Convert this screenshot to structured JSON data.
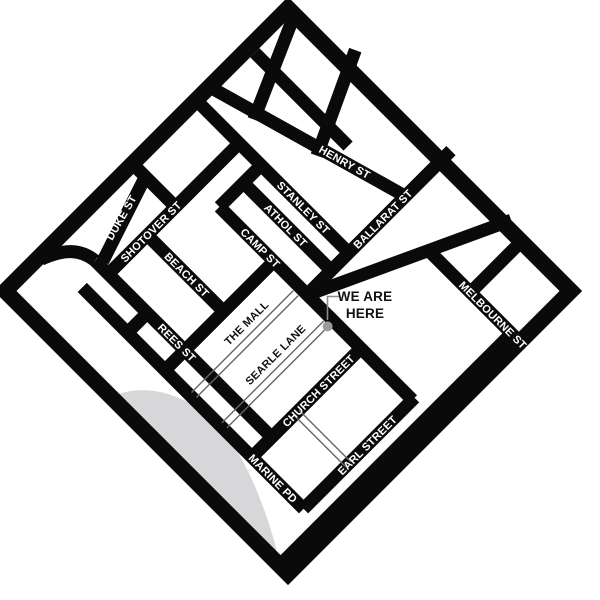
{
  "map": {
    "streets": {
      "henry": "HENRY ST",
      "stanley": "STANLEY ST",
      "athol": "ATHOL ST",
      "camp": "CAMP ST",
      "ballarat": "BALLARAT ST",
      "shotover": "SHOTOVER ST",
      "duke": "DUKE ST",
      "beach": "BEACH ST",
      "rees": "REES ST",
      "melbourne": "MELBOURNE ST",
      "the_mall": "THE MALL",
      "searle": "SEARLE LANE",
      "church": "CHURCH STREET",
      "earl": "EARL STREET",
      "marine": "MARINE PD"
    },
    "marker": {
      "line1": "WE ARE",
      "line2": "HERE"
    },
    "colors": {
      "street": "#0a0a0a",
      "background": "#ffffff",
      "lake": "#d7d7d9",
      "marker_dot": "#9b9b9b",
      "lane_line": "#666666"
    }
  }
}
